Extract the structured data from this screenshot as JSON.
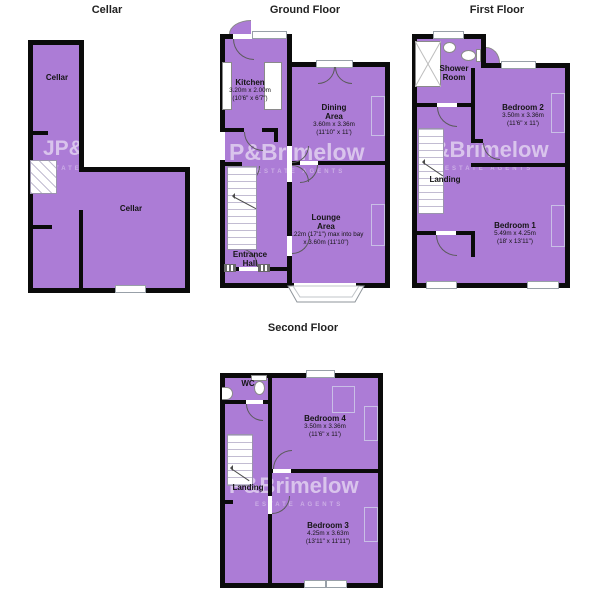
{
  "watermark": {
    "cellar_text": "JP&",
    "brand_text": "P&Brimelow",
    "sub_text": "ESTATE AGENTS"
  },
  "colors": {
    "room_fill": "#AC7CD6",
    "wall": "#0b0b0b"
  },
  "floors": {
    "cellar": {
      "title": "Cellar",
      "room_top": {
        "name": "Cellar"
      },
      "room_main": {
        "name": "Cellar"
      }
    },
    "ground": {
      "title": "Ground Floor",
      "kitchen": {
        "name": "Kitchen",
        "dim_m": "3.20m x 2.00m",
        "dim_ft": "(10'6\" x 6'7\")"
      },
      "dining": {
        "name": "Dining Area",
        "dim_m": "3.60m x 3.36m",
        "dim_ft": "(11'10\" x 11')"
      },
      "lounge": {
        "name": "Lounge Area",
        "dim_m": "5.22m (17'1\") max into bay",
        "dim_ft": "x 3.60m (11'10\")"
      },
      "hall": {
        "name": "Entrance Hall"
      }
    },
    "first": {
      "title": "First Floor",
      "shower": {
        "name": "Shower Room"
      },
      "landing": {
        "name": "Landing"
      },
      "bedroom2": {
        "name": "Bedroom 2",
        "dim_m": "3.50m x 3.36m",
        "dim_ft": "(11'6\" x 11')"
      },
      "bedroom1": {
        "name": "Bedroom 1",
        "dim_m": "5.49m x 4.25m",
        "dim_ft": "(18' x 13'11\")"
      }
    },
    "second": {
      "title": "Second Floor",
      "wc": {
        "name": "WC"
      },
      "landing": {
        "name": "Landing"
      },
      "bedroom4": {
        "name": "Bedroom 4",
        "dim_m": "3.50m x 3.36m",
        "dim_ft": "(11'6\" x 11')"
      },
      "bedroom3": {
        "name": "Bedroom 3",
        "dim_m": "4.25m x 3.63m",
        "dim_ft": "(13'11\" x 11'11\")"
      }
    }
  }
}
